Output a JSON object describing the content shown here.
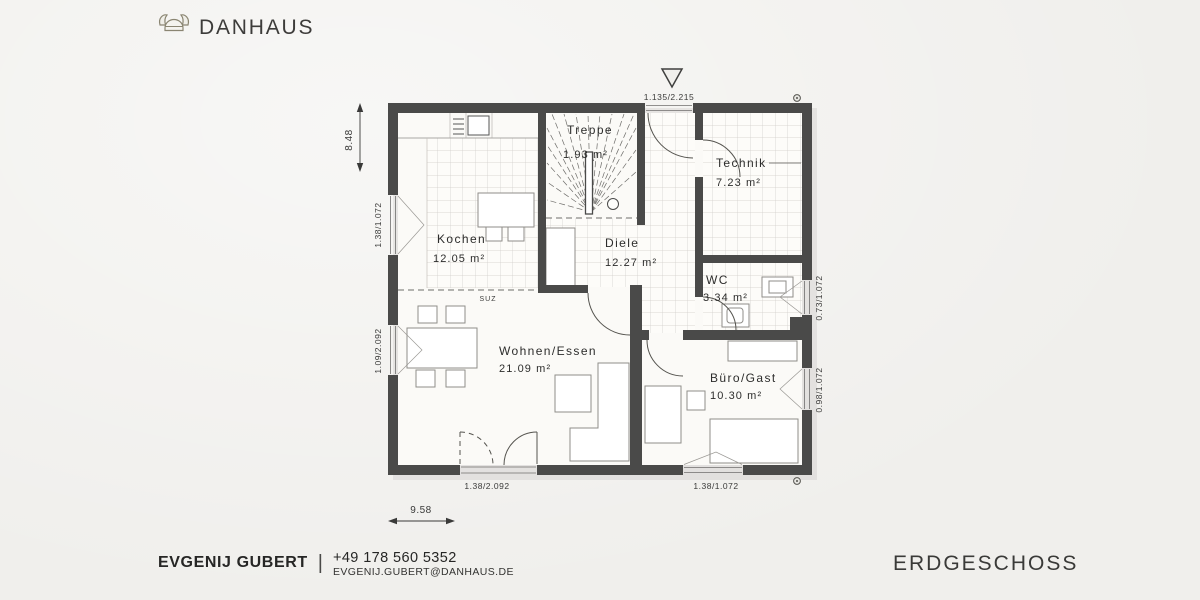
{
  "brand": {
    "name": "DANHAUS"
  },
  "plan": {
    "rooms": {
      "kochen": {
        "name": "Kochen",
        "area": "12.05 m²"
      },
      "treppe": {
        "name": "Treppe",
        "area": "1.93 m²"
      },
      "technik": {
        "name": "Technik",
        "area": "7.23 m²"
      },
      "diele": {
        "name": "Diele",
        "area": "12.27 m²"
      },
      "wc": {
        "name": "WC",
        "area": "3.34 m²"
      },
      "wohnen": {
        "name": "Wohnen/Essen",
        "area": "21.09 m²"
      },
      "buero": {
        "name": "Büro/Gast",
        "area": "10.30 m²"
      }
    },
    "annotations": {
      "suz": "SUZ"
    },
    "dimensions": {
      "overall_width": "9.58",
      "overall_height": "8.48",
      "entry_door": "1.135/2.215",
      "kitchen_window": "1.38/1.072",
      "living_window": "1.09/2.092",
      "wc_window": "0.73/1.072",
      "office_window": "0.98/1.072",
      "terrace_door": "1.38/2.092",
      "office_bottom_window": "1.38/1.072"
    },
    "colors": {
      "wall": "#4a4a49",
      "background": "#f0efec",
      "floor": "#fbfaf7",
      "tile_line": "#cfccc7"
    }
  },
  "footer": {
    "name": "EVGENIJ GUBERT",
    "separator": "|",
    "phone": "+49 178 560 5352",
    "email": "EVGENIJ.GUBERT@DANHAUS.DE",
    "floor": "ERDGESCHOSS"
  }
}
